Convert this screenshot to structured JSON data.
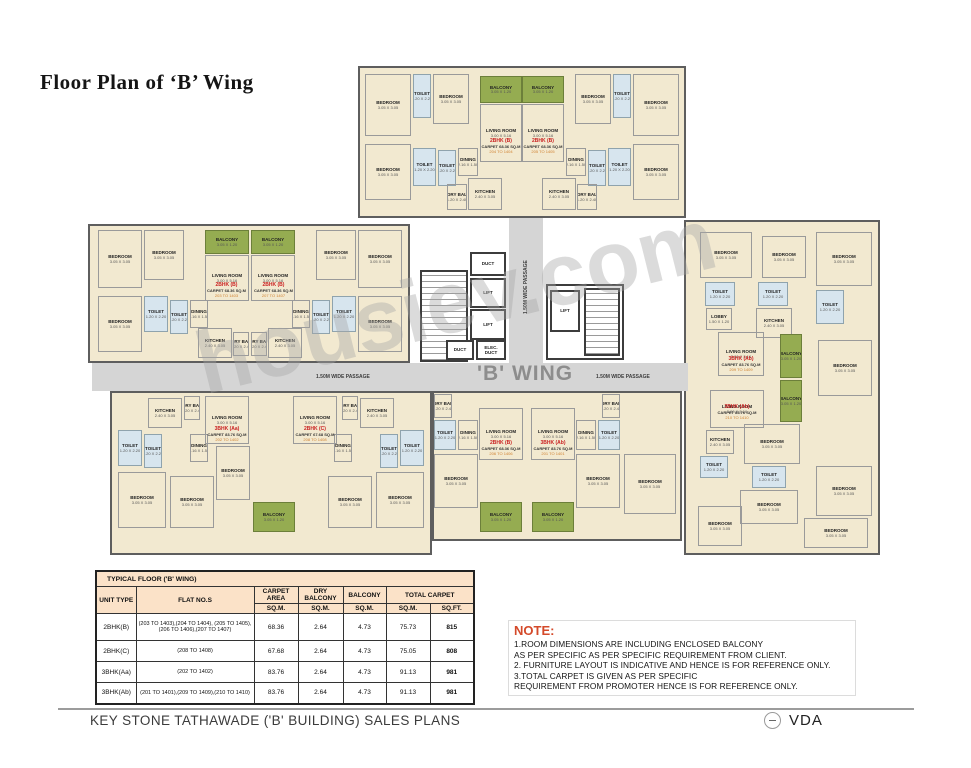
{
  "title": "Floor Plan of ‘B’ Wing",
  "watermark": "housiev.com",
  "plan": {
    "wing_label": "'B' WING",
    "passage_label": "1.50M WIDE PASSAGE",
    "room_dims": {
      "BEDROOM": "3.05 X 3.05",
      "LIVING ROOM": "3.00 X 5.16",
      "KITCHEN": "2.40 X 3.05",
      "TOILET": "1.20 X 2.20",
      "BALCONY": "3.05 X 1.20",
      "DINING": "2.16 X 1.50",
      "DRY BAL": "1.20 X 2.40",
      "LOBBY": "1.50 X 1.20",
      "LIFT": "1.52 X 1.98",
      "DUCT": "",
      "ELEC. DUCT": ""
    },
    "blocks": [
      {
        "x": 358,
        "y": 66,
        "w": 328,
        "h": 152
      },
      {
        "x": 88,
        "y": 224,
        "w": 322,
        "h": 139
      },
      {
        "x": 110,
        "y": 391,
        "w": 322,
        "h": 164
      },
      {
        "x": 432,
        "y": 391,
        "w": 250,
        "h": 150
      },
      {
        "x": 684,
        "y": 220,
        "w": 196,
        "h": 335
      }
    ],
    "corridors": [
      {
        "x": 92,
        "y": 363,
        "w": 596,
        "h": 28
      },
      {
        "x": 509,
        "y": 218,
        "w": 34,
        "h": 145
      }
    ],
    "rooms": [
      {
        "n": "BEDROOM",
        "x": 365,
        "y": 74,
        "w": 46,
        "h": 62
      },
      {
        "n": "TOILET",
        "t": "toilet",
        "x": 413,
        "y": 74,
        "w": 18,
        "h": 44
      },
      {
        "n": "BEDROOM",
        "x": 433,
        "y": 74,
        "w": 36,
        "h": 50
      },
      {
        "n": "BALCONY",
        "t": "balcony",
        "x": 480,
        "y": 76,
        "w": 42,
        "h": 27
      },
      {
        "n": "LIVING ROOM",
        "x": 480,
        "y": 104,
        "w": 42,
        "h": 58
      },
      {
        "n": "BEDROOM",
        "x": 365,
        "y": 144,
        "w": 46,
        "h": 56
      },
      {
        "n": "TOILET",
        "t": "toilet",
        "x": 413,
        "y": 148,
        "w": 23,
        "h": 38
      },
      {
        "n": "TOILET",
        "t": "toilet",
        "x": 438,
        "y": 150,
        "w": 18,
        "h": 36
      },
      {
        "n": "DINING",
        "x": 458,
        "y": 148,
        "w": 20,
        "h": 28
      },
      {
        "n": "KITCHEN",
        "x": 468,
        "y": 178,
        "w": 34,
        "h": 32
      },
      {
        "n": "DRY BAL",
        "x": 447,
        "y": 184,
        "w": 20,
        "h": 26
      },
      {
        "n": "BEDROOM",
        "x": 633,
        "y": 74,
        "w": 46,
        "h": 62
      },
      {
        "n": "TOILET",
        "t": "toilet",
        "x": 613,
        "y": 74,
        "w": 18,
        "h": 44
      },
      {
        "n": "BEDROOM",
        "x": 575,
        "y": 74,
        "w": 36,
        "h": 50
      },
      {
        "n": "BALCONY",
        "t": "balcony",
        "x": 522,
        "y": 76,
        "w": 42,
        "h": 27
      },
      {
        "n": "LIVING ROOM",
        "x": 522,
        "y": 104,
        "w": 42,
        "h": 58
      },
      {
        "n": "BEDROOM",
        "x": 633,
        "y": 144,
        "w": 46,
        "h": 56
      },
      {
        "n": "TOILET",
        "t": "toilet",
        "x": 608,
        "y": 148,
        "w": 23,
        "h": 38
      },
      {
        "n": "TOILET",
        "t": "toilet",
        "x": 588,
        "y": 150,
        "w": 18,
        "h": 36
      },
      {
        "n": "DINING",
        "x": 566,
        "y": 148,
        "w": 20,
        "h": 28
      },
      {
        "n": "KITCHEN",
        "x": 542,
        "y": 178,
        "w": 34,
        "h": 32
      },
      {
        "n": "DRY BAL",
        "x": 577,
        "y": 184,
        "w": 20,
        "h": 26
      },
      {
        "n": "BEDROOM",
        "x": 98,
        "y": 230,
        "w": 44,
        "h": 58
      },
      {
        "n": "BEDROOM",
        "x": 144,
        "y": 230,
        "w": 40,
        "h": 50
      },
      {
        "n": "BALCONY",
        "t": "balcony",
        "x": 205,
        "y": 230,
        "w": 44,
        "h": 24
      },
      {
        "n": "LIVING ROOM",
        "x": 205,
        "y": 255,
        "w": 44,
        "h": 46
      },
      {
        "n": "BEDROOM",
        "x": 98,
        "y": 296,
        "w": 44,
        "h": 56
      },
      {
        "n": "TOILET",
        "t": "toilet",
        "x": 144,
        "y": 296,
        "w": 24,
        "h": 36
      },
      {
        "n": "TOILET",
        "t": "toilet",
        "x": 170,
        "y": 300,
        "w": 18,
        "h": 34
      },
      {
        "n": "DINING",
        "x": 190,
        "y": 300,
        "w": 18,
        "h": 28
      },
      {
        "n": "KITCHEN",
        "x": 198,
        "y": 328,
        "w": 34,
        "h": 30
      },
      {
        "n": "DRY BAL",
        "x": 233,
        "y": 332,
        "w": 16,
        "h": 24
      },
      {
        "n": "BEDROOM",
        "x": 358,
        "y": 230,
        "w": 44,
        "h": 58
      },
      {
        "n": "BEDROOM",
        "x": 316,
        "y": 230,
        "w": 40,
        "h": 50
      },
      {
        "n": "BALCONY",
        "t": "balcony",
        "x": 251,
        "y": 230,
        "w": 44,
        "h": 24
      },
      {
        "n": "LIVING ROOM",
        "x": 251,
        "y": 255,
        "w": 44,
        "h": 46
      },
      {
        "n": "BEDROOM",
        "x": 358,
        "y": 296,
        "w": 44,
        "h": 56
      },
      {
        "n": "TOILET",
        "t": "toilet",
        "x": 332,
        "y": 296,
        "w": 24,
        "h": 36
      },
      {
        "n": "TOILET",
        "t": "toilet",
        "x": 312,
        "y": 300,
        "w": 18,
        "h": 34
      },
      {
        "n": "DINING",
        "x": 292,
        "y": 300,
        "w": 18,
        "h": 28
      },
      {
        "n": "KITCHEN",
        "x": 268,
        "y": 328,
        "w": 34,
        "h": 30
      },
      {
        "n": "DRY BAL",
        "x": 251,
        "y": 332,
        "w": 16,
        "h": 24
      },
      {
        "n": "KITCHEN",
        "x": 148,
        "y": 398,
        "w": 34,
        "h": 30
      },
      {
        "n": "DRY BAL",
        "x": 184,
        "y": 396,
        "w": 16,
        "h": 24
      },
      {
        "n": "TOILET",
        "t": "toilet",
        "x": 118,
        "y": 430,
        "w": 24,
        "h": 36
      },
      {
        "n": "TOILET",
        "t": "toilet",
        "x": 144,
        "y": 434,
        "w": 18,
        "h": 34
      },
      {
        "n": "DINING",
        "x": 190,
        "y": 434,
        "w": 18,
        "h": 28
      },
      {
        "n": "LIVING ROOM",
        "x": 205,
        "y": 396,
        "w": 44,
        "h": 48
      },
      {
        "n": "BEDROOM",
        "x": 216,
        "y": 446,
        "w": 34,
        "h": 54
      },
      {
        "n": "BEDROOM",
        "x": 118,
        "y": 472,
        "w": 48,
        "h": 56
      },
      {
        "n": "BEDROOM",
        "x": 170,
        "y": 476,
        "w": 44,
        "h": 52
      },
      {
        "n": "BALCONY",
        "t": "balcony",
        "x": 253,
        "y": 502,
        "w": 42,
        "h": 30
      },
      {
        "n": "KITCHEN",
        "x": 360,
        "y": 398,
        "w": 34,
        "h": 30
      },
      {
        "n": "DRY BAL",
        "x": 342,
        "y": 396,
        "w": 16,
        "h": 24
      },
      {
        "n": "TOILET",
        "t": "toilet",
        "x": 400,
        "y": 430,
        "w": 24,
        "h": 36
      },
      {
        "n": "TOILET",
        "t": "toilet",
        "x": 380,
        "y": 434,
        "w": 18,
        "h": 34
      },
      {
        "n": "DINING",
        "x": 334,
        "y": 434,
        "w": 18,
        "h": 28
      },
      {
        "n": "LIVING ROOM",
        "x": 293,
        "y": 396,
        "w": 44,
        "h": 48
      },
      {
        "n": "BEDROOM",
        "x": 376,
        "y": 472,
        "w": 48,
        "h": 56
      },
      {
        "n": "BEDROOM",
        "x": 328,
        "y": 476,
        "w": 44,
        "h": 52
      },
      {
        "n": "DRY BAL",
        "x": 434,
        "y": 394,
        "w": 18,
        "h": 24
      },
      {
        "n": "TOILET",
        "t": "toilet",
        "x": 434,
        "y": 420,
        "w": 22,
        "h": 30
      },
      {
        "n": "DINING",
        "x": 458,
        "y": 420,
        "w": 20,
        "h": 30
      },
      {
        "n": "LIVING ROOM",
        "x": 479,
        "y": 408,
        "w": 44,
        "h": 52
      },
      {
        "n": "BEDROOM",
        "x": 434,
        "y": 454,
        "w": 44,
        "h": 54
      },
      {
        "n": "BALCONY",
        "t": "balcony",
        "x": 480,
        "y": 502,
        "w": 42,
        "h": 30
      },
      {
        "n": "DRY BAL",
        "x": 602,
        "y": 394,
        "w": 18,
        "h": 24
      },
      {
        "n": "TOILET",
        "t": "toilet",
        "x": 598,
        "y": 420,
        "w": 22,
        "h": 30
      },
      {
        "n": "DINING",
        "x": 576,
        "y": 420,
        "w": 20,
        "h": 30
      },
      {
        "n": "LIVING ROOM",
        "x": 531,
        "y": 408,
        "w": 44,
        "h": 52
      },
      {
        "n": "BEDROOM",
        "x": 576,
        "y": 454,
        "w": 44,
        "h": 54
      },
      {
        "n": "BALCONY",
        "t": "balcony",
        "x": 532,
        "y": 502,
        "w": 42,
        "h": 30
      },
      {
        "n": "BEDROOM",
        "x": 624,
        "y": 454,
        "w": 52,
        "h": 60
      },
      {
        "n": "BEDROOM",
        "x": 700,
        "y": 232,
        "w": 52,
        "h": 46
      },
      {
        "n": "BEDROOM",
        "x": 762,
        "y": 236,
        "w": 44,
        "h": 42
      },
      {
        "n": "TOILET",
        "t": "toilet",
        "x": 705,
        "y": 282,
        "w": 30,
        "h": 24
      },
      {
        "n": "TOILET",
        "t": "toilet",
        "x": 758,
        "y": 282,
        "w": 30,
        "h": 24
      },
      {
        "n": "KITCHEN",
        "x": 756,
        "y": 308,
        "w": 36,
        "h": 30
      },
      {
        "n": "LOBBY",
        "x": 706,
        "y": 308,
        "w": 26,
        "h": 22
      },
      {
        "n": "LIVING ROOM",
        "x": 718,
        "y": 332,
        "w": 46,
        "h": 44
      },
      {
        "n": "BALCONY",
        "t": "balcony",
        "x": 780,
        "y": 334,
        "w": 22,
        "h": 44
      },
      {
        "n": "BEDROOM",
        "x": 816,
        "y": 232,
        "w": 56,
        "h": 54
      },
      {
        "n": "TOILET",
        "t": "toilet",
        "x": 816,
        "y": 290,
        "w": 28,
        "h": 34
      },
      {
        "n": "BEDROOM",
        "x": 818,
        "y": 340,
        "w": 54,
        "h": 56
      },
      {
        "n": "BALCONY",
        "t": "balcony",
        "x": 780,
        "y": 380,
        "w": 22,
        "h": 42
      },
      {
        "n": "LIVING ROOM",
        "x": 710,
        "y": 390,
        "w": 54,
        "h": 38
      },
      {
        "n": "KITCHEN",
        "x": 706,
        "y": 430,
        "w": 28,
        "h": 24
      },
      {
        "n": "BEDROOM",
        "x": 744,
        "y": 424,
        "w": 56,
        "h": 40
      },
      {
        "n": "TOILET",
        "t": "toilet",
        "x": 700,
        "y": 456,
        "w": 28,
        "h": 22
      },
      {
        "n": "TOILET",
        "t": "toilet",
        "x": 752,
        "y": 466,
        "w": 34,
        "h": 22
      },
      {
        "n": "BEDROOM",
        "x": 740,
        "y": 490,
        "w": 58,
        "h": 34
      },
      {
        "n": "BEDROOM",
        "x": 698,
        "y": 506,
        "w": 44,
        "h": 40
      },
      {
        "n": "BEDROOM",
        "x": 816,
        "y": 466,
        "w": 56,
        "h": 50
      },
      {
        "n": "BEDROOM",
        "x": 804,
        "y": 518,
        "w": 64,
        "h": 30
      }
    ],
    "core": [
      {
        "n": "",
        "t": "stair",
        "x": 420,
        "y": 270,
        "w": 48,
        "h": 92
      },
      {
        "n": "DUCT",
        "t": "duct",
        "x": 470,
        "y": 252,
        "w": 36,
        "h": 24
      },
      {
        "n": "LIFT",
        "t": "lift",
        "x": 470,
        "y": 278,
        "w": 36,
        "h": 30
      },
      {
        "n": "LIFT",
        "t": "lift",
        "x": 470,
        "y": 309,
        "w": 36,
        "h": 31
      },
      {
        "n": "DUCT",
        "t": "duct",
        "x": 446,
        "y": 340,
        "w": 28,
        "h": 20
      },
      {
        "n": "ELEC. DUCT",
        "t": "duct",
        "x": 476,
        "y": 340,
        "w": 30,
        "h": 20
      },
      {
        "n": "",
        "t": "corebox",
        "x": 546,
        "y": 284,
        "w": 78,
        "h": 76
      },
      {
        "n": "LIFT",
        "t": "lift",
        "x": 550,
        "y": 290,
        "w": 30,
        "h": 42
      },
      {
        "n": "",
        "t": "stair",
        "x": 584,
        "y": 288,
        "w": 36,
        "h": 68
      }
    ],
    "unit_labels": [
      {
        "type": "2BHK (B)",
        "carpet": "CARPET 68.36 SQ.M",
        "flats": "204 TO 1404",
        "x": 479,
        "y": 138,
        "w": 44
      },
      {
        "type": "2BHK (B)",
        "carpet": "CARPET 68.36 SQ.M",
        "flats": "205 TO 1405",
        "x": 521,
        "y": 138,
        "w": 44
      },
      {
        "type": "2BHK (B)",
        "carpet": "CARPET 68.36 SQ.M",
        "flats": "203 TO 1403",
        "x": 204,
        "y": 282,
        "w": 45
      },
      {
        "type": "2BHK (B)",
        "carpet": "CARPET 68.36 SQ.M",
        "flats": "207 TO 1407",
        "x": 251,
        "y": 282,
        "w": 45
      },
      {
        "type": "3BHK (Aa)",
        "carpet": "CARPET 83.76 SQ.M",
        "flats": "202 TO 1402",
        "x": 205,
        "y": 426,
        "w": 44
      },
      {
        "type": "2BHK (C)",
        "carpet": "CARPET 67.68 SQ.M",
        "flats": "208 TO 1408",
        "x": 293,
        "y": 426,
        "w": 44
      },
      {
        "type": "2BHK (B)",
        "carpet": "CARPET 68.36 SQ.M",
        "flats": "206 TO 1406",
        "x": 479,
        "y": 440,
        "w": 44
      },
      {
        "type": "3BHK (Ab)",
        "carpet": "CARPET 83.76 SQ.M",
        "flats": "201 TO 1401",
        "x": 531,
        "y": 440,
        "w": 44
      },
      {
        "type": "3BHK (Ab)",
        "carpet": "CARPET 83.76 SQ.M",
        "flats": "209 TO 1409",
        "x": 716,
        "y": 356,
        "w": 50
      },
      {
        "type": "3BHK (Ab)",
        "carpet": "CARPET 83.76 SQ.M",
        "flats": "210 TO 1410",
        "x": 710,
        "y": 404,
        "w": 54
      }
    ]
  },
  "table": {
    "title": "TYPICAL FLOOR ('B' WING)",
    "col_unit": "UNIT TYPE",
    "col_flats": "FLAT NO.S",
    "col_carpet": "CARPET AREA",
    "col_dry": "DRY BALCONY",
    "col_balcony": "BALCONY",
    "col_total": "TOTAL CARPET",
    "unit_sqm": "SQ.M.",
    "unit_sqft": "SQ.FT.",
    "rows": [
      {
        "unit_type": "2BHK(B)",
        "flats": "(203 TO 1403),(204 TO 1404), (205 TO 1405),(206 TO 1406),(207 TO 1407)",
        "carpet_sqm": "68.36",
        "dry_balcony_sqm": "2.64",
        "balcony_sqm": "4.73",
        "total_sqm": "75.73",
        "total_sqft": "815"
      },
      {
        "unit_type": "2BHK(C)",
        "flats": "(208 TO 1408)",
        "carpet_sqm": "67.68",
        "dry_balcony_sqm": "2.64",
        "balcony_sqm": "4.73",
        "total_sqm": "75.05",
        "total_sqft": "808"
      },
      {
        "unit_type": "3BHK(Aa)",
        "flats": "(202 TO 1402)",
        "carpet_sqm": "83.76",
        "dry_balcony_sqm": "2.64",
        "balcony_sqm": "4.73",
        "total_sqm": "91.13",
        "total_sqft": "981"
      },
      {
        "unit_type": "3BHK(Ab)",
        "flats": "(201 TO 1401),(209 TO 1409),(210 TO 1410)",
        "carpet_sqm": "83.76",
        "dry_balcony_sqm": "2.64",
        "balcony_sqm": "4.73",
        "total_sqm": "91.13",
        "total_sqft": "981"
      }
    ]
  },
  "note": {
    "heading": "NOTE:",
    "lines": [
      "1.ROOM DIMENSIONS ARE INCLUDING ENCLOSED BALCONY",
      "AS PER SPECIFIC AS PER SPECIFIC REQUIREMENT FROM CLIENT.",
      "2. FURNITURE LAYOUT IS INDICATIVE AND HENCE IS FOR REFERENCE ONLY.",
      "3.TOTAL CARPET IS GIVEN AS PER SPECIFIC",
      "REQUIREMENT FROM PROMOTER HENCE IS FOR REFERENCE ONLY."
    ]
  },
  "footer": {
    "title": "KEY STONE TATHAWADE ('B' BUILDING) SALES PLANS",
    "logo_text": "VDA"
  }
}
